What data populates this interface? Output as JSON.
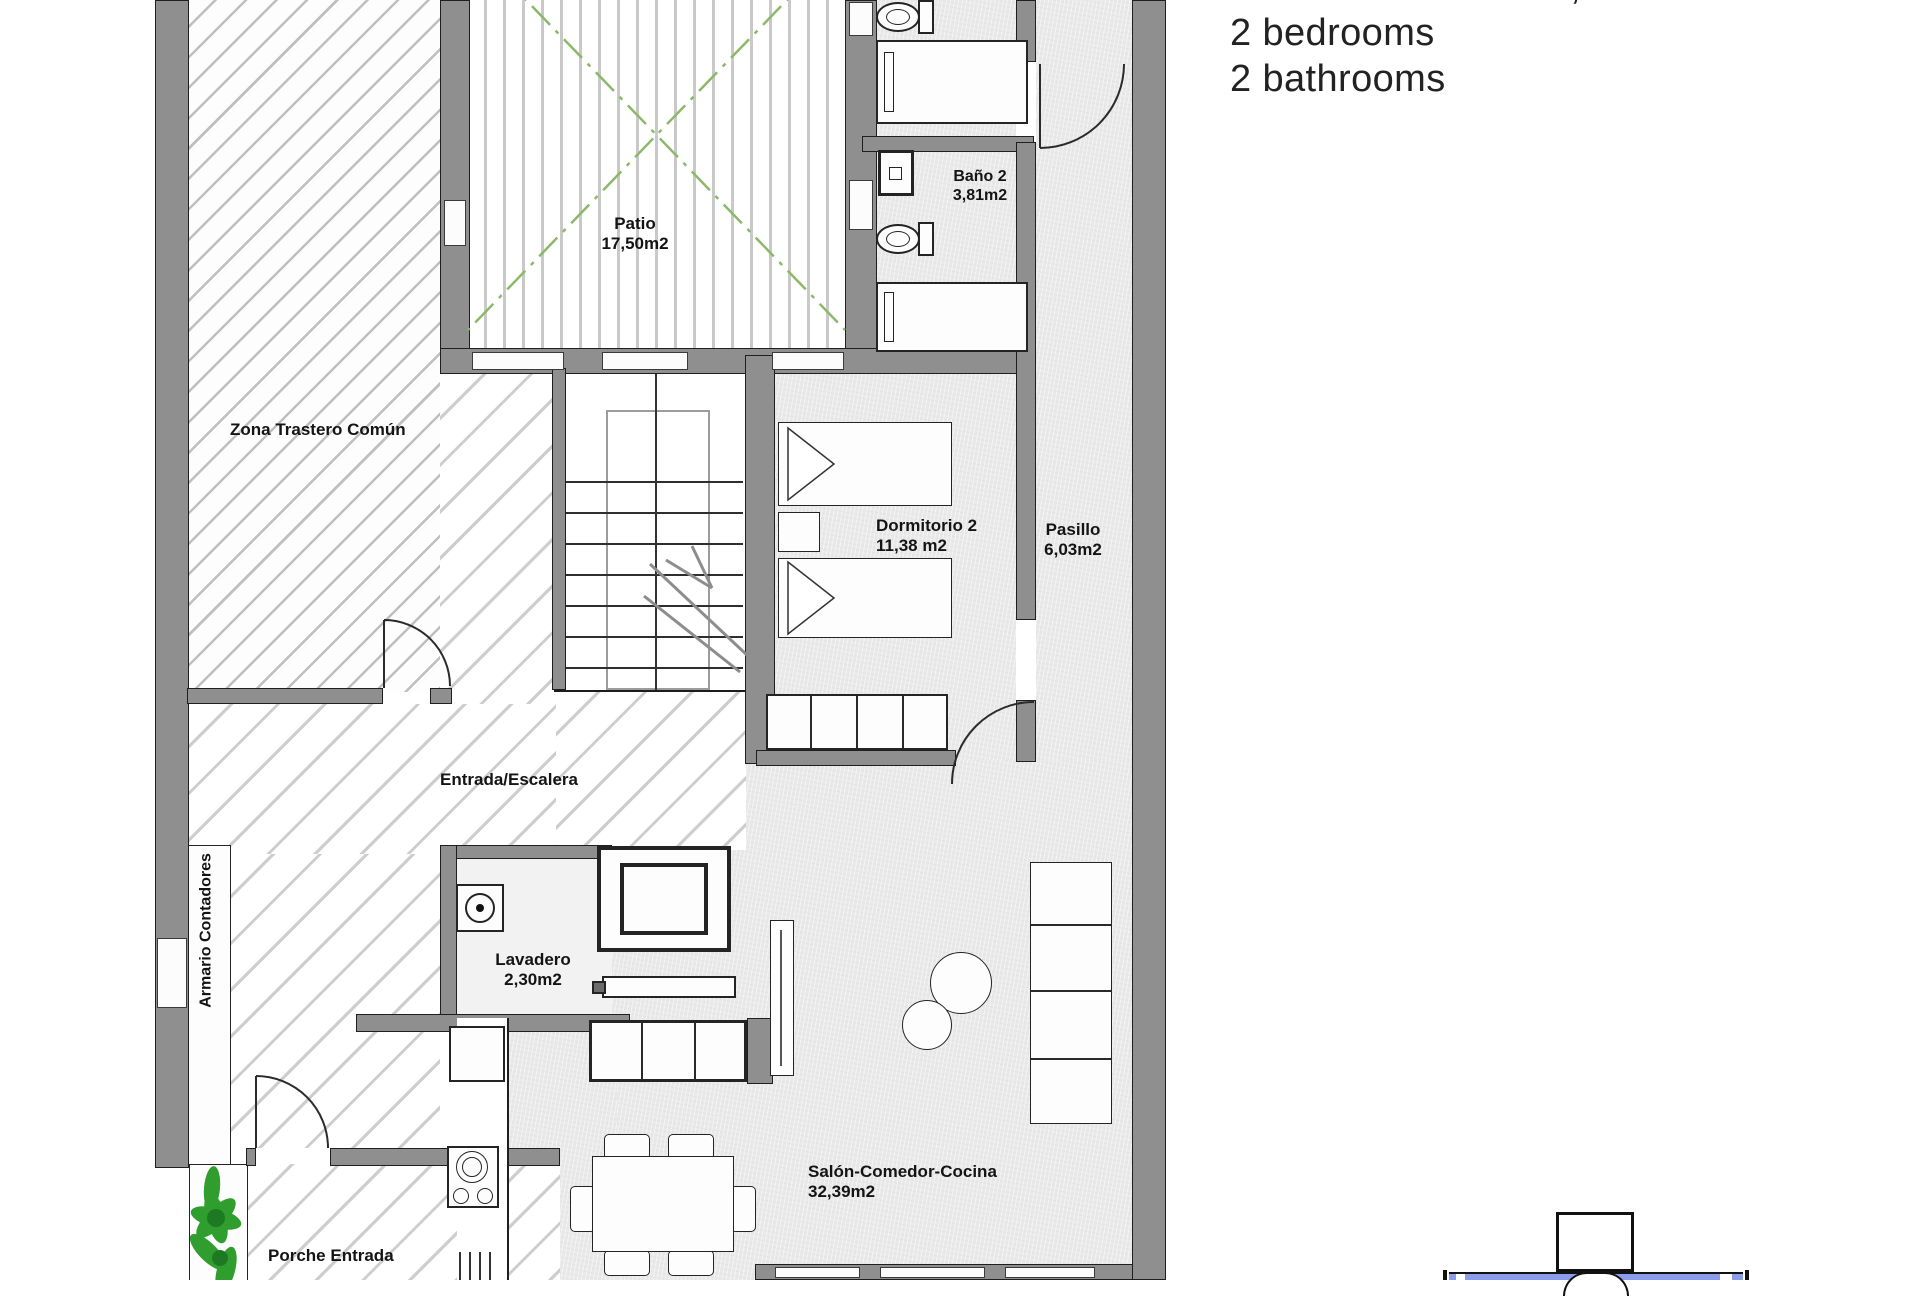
{
  "summary": {
    "line1": "Total built area: 101,45m2",
    "line2": "2 bedrooms",
    "line3": "2 bathrooms"
  },
  "plan": {
    "zona_trastero": {
      "name": "Zona Trastero Común"
    },
    "patio": {
      "name": "Patio",
      "area": "17,50m2"
    },
    "bano2": {
      "name": "Baño 2",
      "area": "3,81m2"
    },
    "dormitorio2": {
      "name": "Dormitorio 2",
      "area": "11,38 m2"
    },
    "pasillo": {
      "name": "Pasillo",
      "area": "6,03m2"
    },
    "entrada": {
      "name": "Entrada/Escalera"
    },
    "lavadero": {
      "name": "Lavadero",
      "area": "2,30m2"
    },
    "armario": {
      "name": "Armario Contadores"
    },
    "salon": {
      "name": "Salón-Comedor-Cocina",
      "area": "32,39m2"
    },
    "porche": {
      "name": "Porche Entrada"
    }
  },
  "colors": {
    "wall_gray": "#8f8f8f",
    "floor_gray": "#e9e9e9",
    "patio_line_green": "#8cb86a",
    "plant_green": "#2f9e2f",
    "site_plan_blue": "#8b9ce8"
  }
}
